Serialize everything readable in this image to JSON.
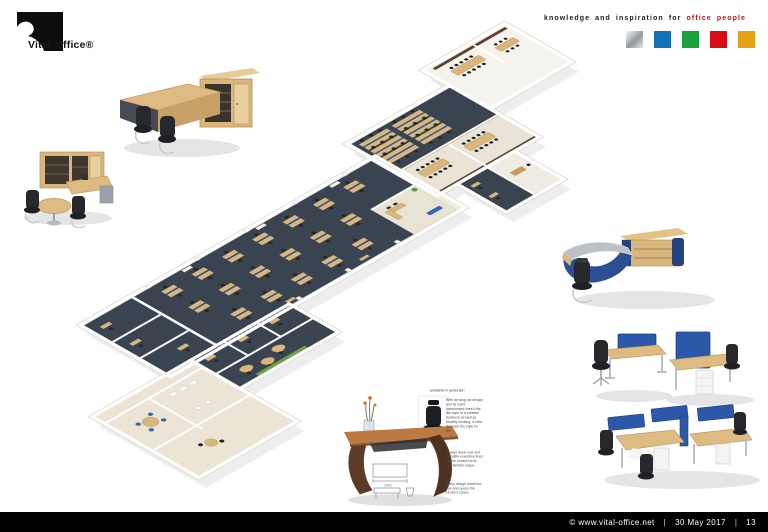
{
  "header": {
    "logo": {
      "text": "Vital-Office®"
    },
    "tagline": {
      "prefix": "knowledge and inspiration for ",
      "highlight": "office people",
      "highlight_color": "#cc1016"
    },
    "palette": [
      {
        "name": "silver",
        "css": "background:linear-gradient(135deg,#f8f8f8 0%,#94979b 55%,#e6e6e6 100%)"
      },
      {
        "name": "blue",
        "css": "background:#1470b8"
      },
      {
        "name": "green",
        "css": "background:#17a23e"
      },
      {
        "name": "red",
        "css": "background:#d60d17"
      },
      {
        "name": "amber",
        "css": "background:#e6a313"
      }
    ]
  },
  "fine_print": {
    "caption": "ambiente in perfection",
    "para1": "With its wing cut design and its hand harmonised lines it fits the style of a creative business as well as healthy working, a view that sets the style for life.",
    "para2": "Always desk, real and versatile executive lines for the comfort of its soft familiar shape.",
    "para3": "Every design leads the eye and opens the centre's space."
  },
  "sketch": {
    "dimension": "2000"
  },
  "footer": {
    "copyright": "© www.vital-office.net",
    "sep1": "|",
    "date": "30 May 2017",
    "sep2": "|",
    "page": "13"
  },
  "floorplan_colors": {
    "carpet": "#3a4350",
    "desk_beech": "#d9b77c",
    "screen_blue": "#2b4f92",
    "wall_white": "#ffffff",
    "panel_brown": "#5a4332",
    "accent_green": "#6fa046"
  }
}
